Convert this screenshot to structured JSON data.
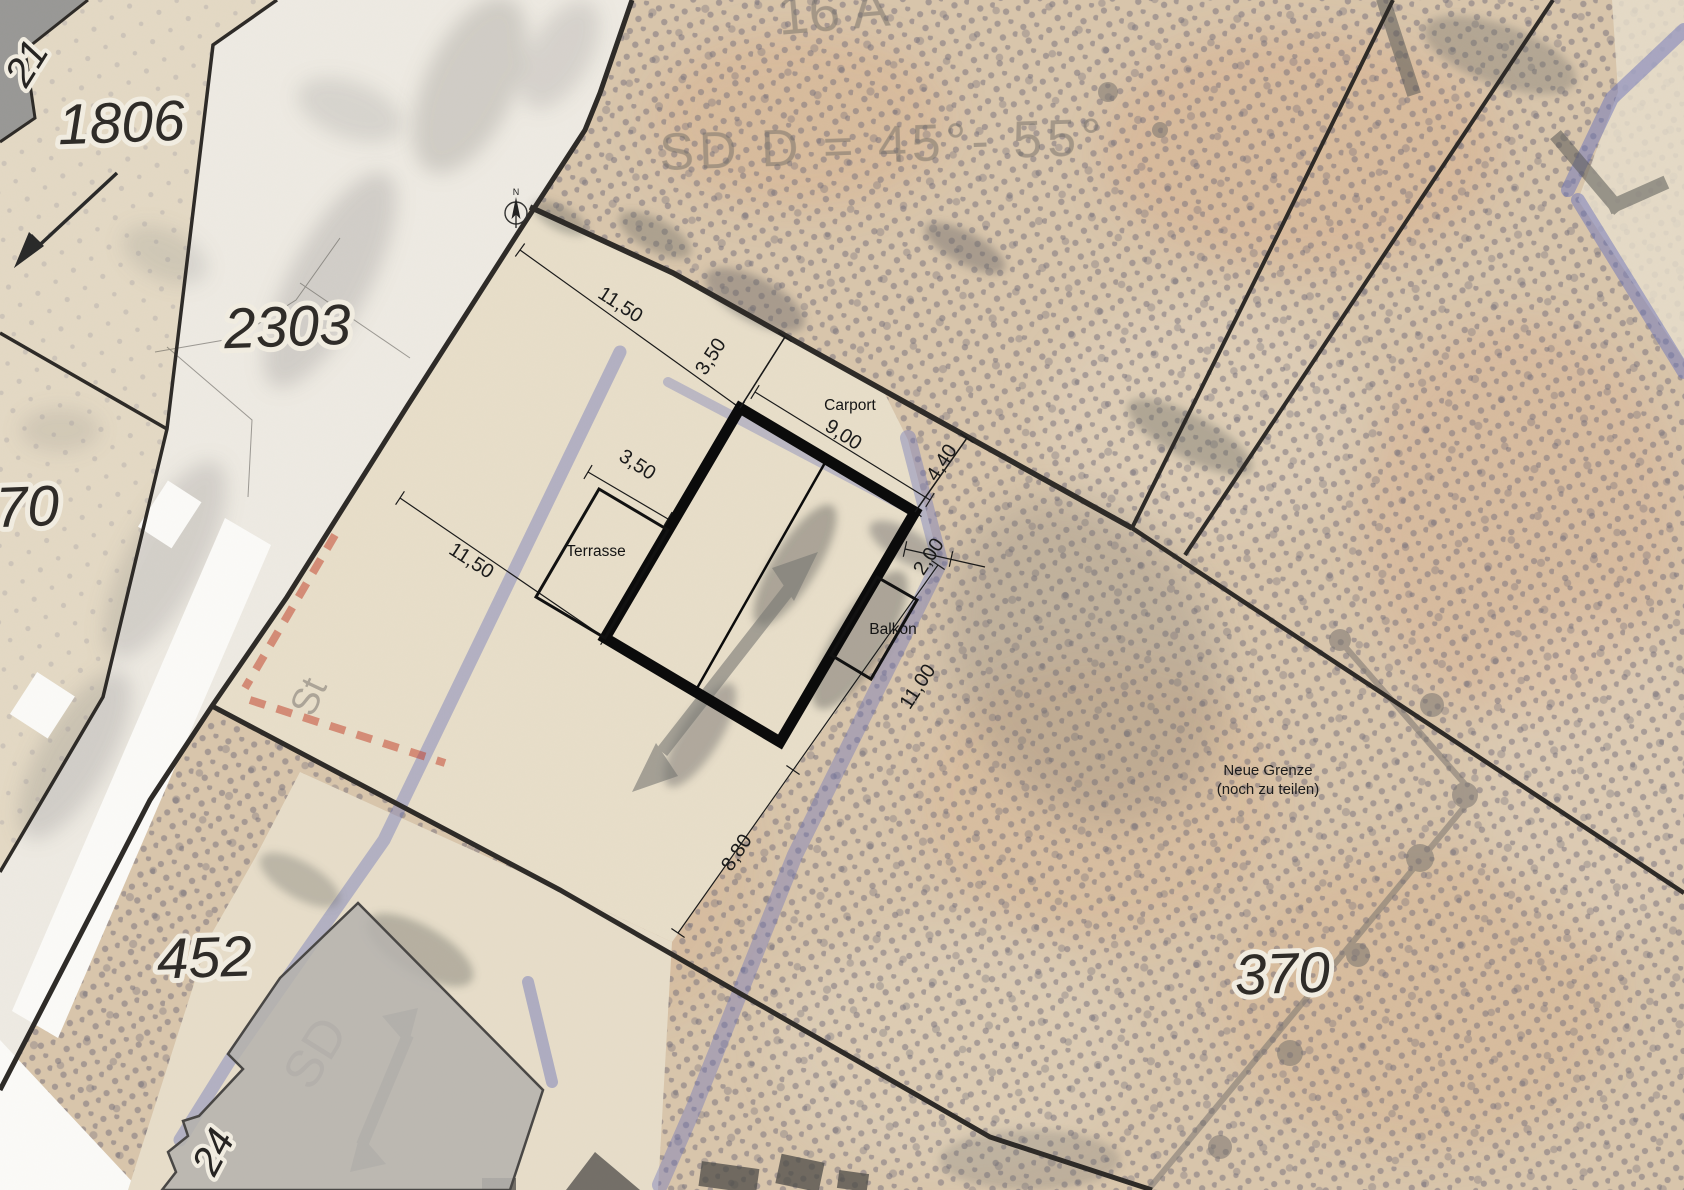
{
  "map": {
    "parcels": {
      "p1806": "1806",
      "p2303": "2303",
      "p70": "70",
      "p452": "452",
      "p370": "370",
      "p21": "21",
      "p24": "24"
    },
    "building_labels": {
      "carport": "Carport",
      "terrasse": "Terrasse",
      "balkon": "Balkon"
    },
    "dimensions": {
      "top_1150": "11,50",
      "carport_350": "3,50",
      "carport_900": "9,00",
      "east_440": "4,40",
      "terrasse_350": "3,50",
      "balkon_200": "2,00",
      "east_1100": "11,00",
      "south_880": "8,80",
      "west_1150": "11,50"
    },
    "notes": {
      "neue_grenze_1": "Neue Grenze",
      "neue_grenze_2": "(noch zu teilen)"
    },
    "ghosts": {
      "house_number": "16 A",
      "roof_spec": "SD   D = 45°- 55°",
      "sd_main": "SD",
      "sd_small": "St"
    },
    "compass": {
      "north": "N"
    },
    "colors": {
      "paper": "#dbc8af",
      "halftone_dot": "#756f7d",
      "plot_strip": "#eae1cd",
      "road": "#f0ede7",
      "boundary": "#2e2b28",
      "building": "#0b0b0b",
      "old_plan_blue": "#6b74bd",
      "old_plan_red": "#c43c26",
      "neighbor_building": "#b7b5b2"
    }
  }
}
